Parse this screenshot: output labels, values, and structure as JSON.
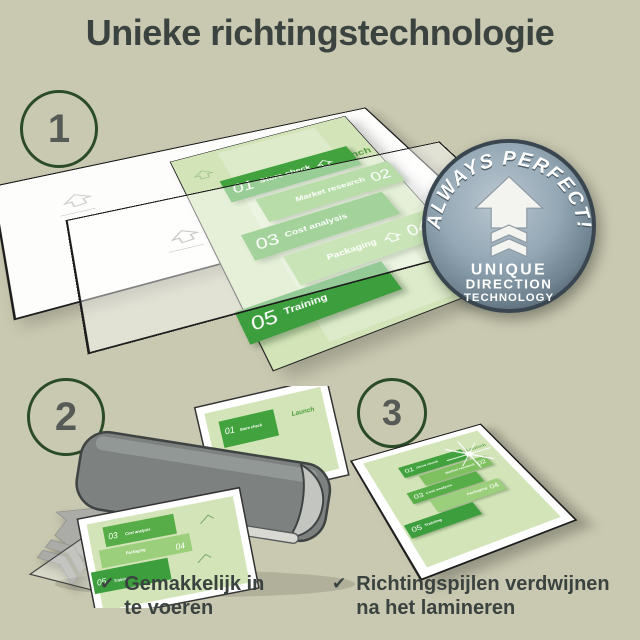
{
  "title": "Unieke richtingstechnologie",
  "steps": {
    "one": "1",
    "two": "2",
    "three": "3"
  },
  "badge": {
    "arc_text": "ALWAYS PERFECT!",
    "line1": "UNIQUE",
    "line2": "DIRECTION",
    "line3": "TECHNOLOGY"
  },
  "document": {
    "launch_label": "Launch",
    "items": [
      {
        "num": "01",
        "label": "Store check"
      },
      {
        "num": "02",
        "label": "Market research"
      },
      {
        "num": "03",
        "label": "Cost analysis"
      },
      {
        "num": "04",
        "label": "Packaging"
      },
      {
        "num": "05",
        "label": "Training"
      }
    ]
  },
  "captions": {
    "step2": {
      "check": "✔",
      "line1": "Gemakkelijk in",
      "line2": "te voeren"
    },
    "step3": {
      "check": "✔",
      "line1": "Richtingspijlen verdwijnen",
      "line2": "na het lamineren"
    }
  },
  "colors": {
    "background": "#c9c9b1",
    "title_text": "#3b4340",
    "circle_ring": "#2a4a28",
    "badge_metal": "#8ba0af",
    "doc_bg": "#d2e4b8",
    "doc_green_dark": "#42a33e",
    "doc_green_mid": "#57ad47",
    "doc_green_light": "#9ccf7b",
    "laminator_gray": "#7d8180",
    "arrow_gray": "#abaca7"
  }
}
